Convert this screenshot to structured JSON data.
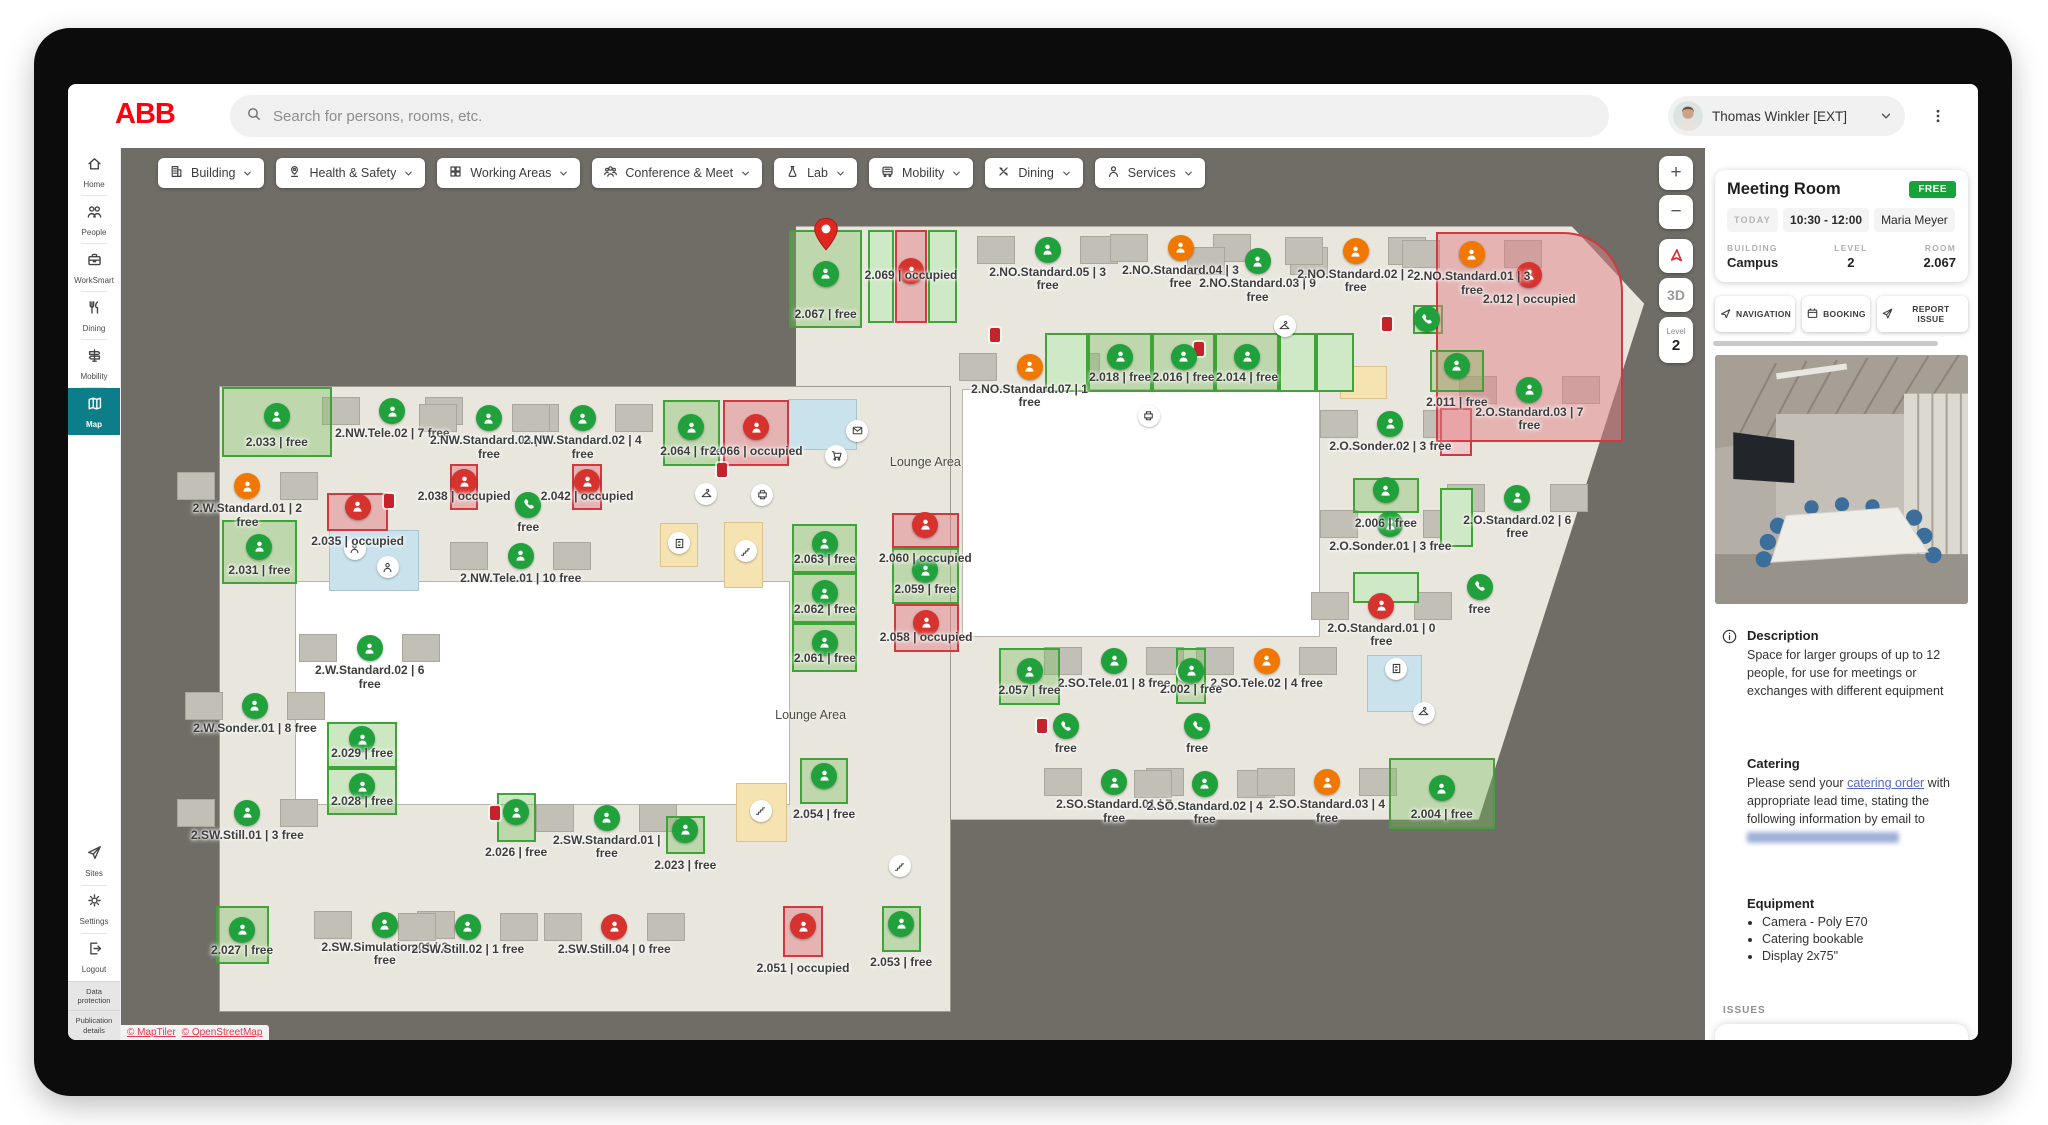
{
  "topbar": {
    "logo": "ABB",
    "search_placeholder": "Search for persons, rooms, etc.",
    "user_name": "Thomas Winkler [EXT]"
  },
  "sidebar": {
    "items": [
      {
        "label": "Home",
        "icon": "home"
      },
      {
        "label": "People",
        "icon": "people"
      },
      {
        "label": "WorkSmart",
        "icon": "worksmart"
      },
      {
        "label": "Dining",
        "icon": "dining"
      },
      {
        "label": "Mobility",
        "icon": "mobility"
      },
      {
        "label": "Map",
        "icon": "map",
        "active": true
      }
    ],
    "bottom_items": [
      {
        "label": "Sites",
        "icon": "sites"
      },
      {
        "label": "Settings",
        "icon": "settings"
      },
      {
        "label": "Logout",
        "icon": "logout"
      }
    ],
    "footer_links": [
      "Data protection",
      "Publication details"
    ]
  },
  "filters": [
    {
      "label": "Building",
      "icon": "building"
    },
    {
      "label": "Health & Safety",
      "icon": "health"
    },
    {
      "label": "Working Areas",
      "icon": "grid"
    },
    {
      "label": "Conference & Meet",
      "icon": "group"
    },
    {
      "label": "Lab",
      "icon": "flask"
    },
    {
      "label": "Mobility",
      "icon": "bus"
    },
    {
      "label": "Dining",
      "icon": "cutlery"
    },
    {
      "label": "Services",
      "icon": "person"
    }
  ],
  "map": {
    "controls": {
      "zoom_in": "+",
      "zoom_out": "−",
      "mode_3d": "3D",
      "level_label": "Level",
      "level_value": "2"
    },
    "attribution": [
      "© MapTiler",
      "© OpenStreetMap"
    ],
    "areas": [
      {
        "label": "Lounge Area",
        "x": 48.7,
        "y": 35.2
      },
      {
        "label": "Lounge Area",
        "x": 41.1,
        "y": 63.6
      }
    ],
    "zones": [
      {
        "cls": "floor-right",
        "x": 40.1,
        "y": 8.8,
        "w": 56.2,
        "h": 66.5
      },
      {
        "cls": "floor",
        "x": 2.0,
        "y": 26.8,
        "w": 48.3,
        "h": 70.0
      },
      {
        "cls": "court",
        "x": 51.2,
        "y": 27.1,
        "w": 23.6,
        "h": 27.6
      },
      {
        "cls": "court",
        "x": 7.0,
        "y": 48.6,
        "w": 32.7,
        "h": 24.9
      },
      {
        "cls": "wc",
        "x": 9.3,
        "y": 42.9,
        "w": 5.8,
        "h": 6.6
      },
      {
        "cls": "wc",
        "x": 39.7,
        "y": 28.2,
        "w": 4.4,
        "h": 5.5
      },
      {
        "cls": "wc",
        "x": 78.0,
        "y": 56.9,
        "w": 3.5,
        "h": 6.2
      },
      {
        "cls": "stairs",
        "x": 31.2,
        "y": 42.2,
        "w": 2.4,
        "h": 4.7
      },
      {
        "cls": "stairs",
        "x": 35.4,
        "y": 42.0,
        "w": 2.5,
        "h": 7.2
      },
      {
        "cls": "stairs",
        "x": 36.2,
        "y": 71.3,
        "w": 3.3,
        "h": 6.4
      },
      {
        "cls": "stairs",
        "x": 76.2,
        "y": 24.5,
        "w": 3.0,
        "h": 3.5
      },
      {
        "cls": "greenbox",
        "x": 44.9,
        "y": 9.2,
        "w": 1.7,
        "h": 10.4
      },
      {
        "cls": "greenbox",
        "x": 48.9,
        "y": 9.2,
        "w": 1.9,
        "h": 10.4
      },
      {
        "cls": "greenbox",
        "x": 56.6,
        "y": 20.7,
        "w": 2.9,
        "h": 6.6
      },
      {
        "cls": "greenbox",
        "x": 72.1,
        "y": 20.7,
        "w": 2.5,
        "h": 6.6
      },
      {
        "cls": "greenbox",
        "x": 74.6,
        "y": 20.7,
        "w": 2.5,
        "h": 6.6
      },
      {
        "cls": "greenbox",
        "x": 82.8,
        "y": 38.1,
        "w": 2.2,
        "h": 6.6
      },
      {
        "cls": "greenbox",
        "x": 77.0,
        "y": 47.5,
        "w": 4.4,
        "h": 3.5
      },
      {
        "cls": "greenbox",
        "x": 81.0,
        "y": 17.6,
        "w": 2.0,
        "h": 3.2
      },
      {
        "cls": "redbox",
        "x": 82.8,
        "y": 29.1,
        "w": 2.1,
        "h": 5.4
      }
    ],
    "rooms": [
      {
        "label": "2.NO.Standard.05 | 3 free",
        "dot": "green",
        "x": 56.8,
        "y": 14.7
      },
      {
        "label": "2.NO.Standard.04 | 3 free",
        "dot": "orange",
        "x": 65.6,
        "y": 14.5
      },
      {
        "label": "2.NO.Standard.03 | 9 free",
        "dot": "green",
        "x": 70.7,
        "y": 16.0
      },
      {
        "label": "2.NO.Standard.02 | 2 free",
        "dot": "orange",
        "x": 77.2,
        "y": 14.9
      },
      {
        "label": "2.NO.Standard.01 | 3 free",
        "dot": "orange",
        "x": 84.9,
        "y": 15.2
      },
      {
        "label": "2.NO.Standard.07 | 1 free",
        "dot": "orange",
        "x": 55.6,
        "y": 27.8
      },
      {
        "label": "2.O.Standard.03 | 7 free",
        "dot": "green",
        "x": 88.7,
        "y": 30.4
      },
      {
        "label": "2.O.Sonder.02 | 3 free",
        "dot": "green",
        "x": 79.5,
        "y": 34.2
      },
      {
        "label": "2.O.Standard.02 | 6 free",
        "dot": "green",
        "x": 87.9,
        "y": 42.5
      },
      {
        "label": "2.O.Sonder.01 | 3 free",
        "dot": "green",
        "x": 79.5,
        "y": 45.5
      },
      {
        "label": "2.O.Standard.01 | 0 free",
        "dot": "red",
        "x": 78.9,
        "y": 54.6
      },
      {
        "label": "2.NW.Tele.02 | 7 free",
        "dot": "green",
        "x": 13.4,
        "y": 32.8
      },
      {
        "label": "2.NW.Standard.03 | 3 free",
        "dot": "green",
        "x": 19.8,
        "y": 33.6
      },
      {
        "label": "2.NW.Standard.02 | 4 free",
        "dot": "green",
        "x": 26.0,
        "y": 33.6
      },
      {
        "label": "2.W.Standard.01 | 2 free",
        "dot": "orange",
        "x": 3.8,
        "y": 41.2
      },
      {
        "label": "2.NW.Tele.01 | 10 free",
        "dot": "green",
        "x": 21.9,
        "y": 49.0
      },
      {
        "label": "2.W.Standard.02 | 6 free",
        "dot": "green",
        "x": 11.9,
        "y": 59.4
      },
      {
        "label": "2.W.Sonder.01 | 8 free",
        "dot": "green",
        "x": 4.3,
        "y": 65.8
      },
      {
        "label": "2.SO.Tele.01 | 8 free",
        "dot": "green",
        "x": 61.2,
        "y": 60.8
      },
      {
        "label": "2.SO.Tele.02 | 4 free",
        "dot": "orange",
        "x": 71.3,
        "y": 60.8
      },
      {
        "label": "2.SO.Standard.01 | 7 free",
        "dot": "green",
        "x": 61.2,
        "y": 74.4
      },
      {
        "label": "2.SO.Standard.02 | 4 free",
        "dot": "green",
        "x": 67.2,
        "y": 74.6
      },
      {
        "label": "2.SO.Standard.03 | 4 free",
        "dot": "orange",
        "x": 75.3,
        "y": 74.4
      },
      {
        "label": "2.SW.Still.01 | 3 free",
        "dot": "green",
        "x": 3.8,
        "y": 77.8
      },
      {
        "label": "2.SW.Standard.01 | free",
        "dot": "green",
        "x": 27.6,
        "y": 78.4
      },
      {
        "label": "2.SW.Simulation.01 | 2 free",
        "dot": "green",
        "x": 12.9,
        "y": 90.4
      },
      {
        "label": "2.SW.Still.02 | 1 free",
        "dot": "green",
        "x": 18.4,
        "y": 90.6
      },
      {
        "label": "2.SW.Still.04 | 0 free",
        "dot": "red",
        "x": 28.1,
        "y": 90.6
      },
      {
        "label": "free",
        "dot": "phone",
        "x": 85.4,
        "y": 49.2
      },
      {
        "label": "free",
        "dot": "phone",
        "x": 22.4,
        "y": 40.0
      },
      {
        "label": "free",
        "dot": "phone",
        "x": 58.0,
        "y": 64.8
      },
      {
        "label": "free",
        "dot": "phone",
        "x": 66.7,
        "y": 64.8
      },
      {
        "label": "",
        "dot": "phone",
        "x": 81.9,
        "y": 19.2
      },
      {
        "label": "2.067 | free",
        "box": "green",
        "dot": "green",
        "pin": true,
        "x": 39.7,
        "y": 9.2,
        "w": 4.8,
        "h": 11.0
      },
      {
        "label": "2.069 | occupied",
        "box": "red",
        "dot": "red",
        "x": 46.7,
        "y": 9.2,
        "w": 2.1,
        "h": 10.4,
        "label_y": 13.6
      },
      {
        "label": "2.012 | occupied",
        "box": "red",
        "dot": "red",
        "x": 82.5,
        "y": 9.4,
        "w": 12.4,
        "h": 23.6,
        "round": true,
        "dot_y": 14.2,
        "label_y": 16.2
      },
      {
        "label": "2.018 | free",
        "box": "green",
        "dot": "green",
        "x": 59.5,
        "y": 20.7,
        "w": 4.2,
        "h": 6.6
      },
      {
        "label": "2.016 | free",
        "box": "green",
        "dot": "green",
        "x": 63.7,
        "y": 20.7,
        "w": 4.2,
        "h": 6.6
      },
      {
        "label": "2.014 | free",
        "box": "green",
        "dot": "green",
        "x": 67.9,
        "y": 20.7,
        "w": 4.2,
        "h": 6.6
      },
      {
        "label": "2.011 | free",
        "box": "green",
        "dot": "green",
        "x": 82.1,
        "y": 22.7,
        "w": 3.6,
        "h": 4.6,
        "label_below": true
      },
      {
        "label": "2.006 | free",
        "box": "green",
        "dot": "green",
        "x": 77.0,
        "y": 37.0,
        "w": 4.4,
        "h": 3.9,
        "label_below": true
      },
      {
        "label": "2.033 | free",
        "box": "green",
        "dot": "green",
        "x": 2.1,
        "y": 26.8,
        "w": 7.3,
        "h": 7.8
      },
      {
        "label": "2.038 | occupied",
        "box": "red",
        "dot": "red",
        "x": 17.2,
        "y": 35.4,
        "w": 1.9,
        "h": 5.2
      },
      {
        "label": "2.042 | occupied",
        "box": "red",
        "dot": "red",
        "x": 25.3,
        "y": 35.4,
        "w": 2.0,
        "h": 5.2
      },
      {
        "label": "2.035 | occupied",
        "box": "red",
        "dot": "red",
        "x": 9.1,
        "y": 38.7,
        "w": 4.0,
        "h": 4.2,
        "label_below": true
      },
      {
        "label": "2.031 | free",
        "box": "green",
        "dot": "green",
        "x": 2.1,
        "y": 41.7,
        "w": 5.0,
        "h": 7.2
      },
      {
        "label": "2.064 | free",
        "box": "green",
        "dot": "green",
        "x": 31.3,
        "y": 28.2,
        "w": 3.8,
        "h": 7.4
      },
      {
        "label": "2.066 | occupied",
        "box": "red",
        "dot": "red",
        "x": 35.3,
        "y": 28.2,
        "w": 4.4,
        "h": 7.4
      },
      {
        "label": "2.063 | free",
        "box": "green",
        "dot": "green",
        "x": 39.9,
        "y": 42.2,
        "w": 4.3,
        "h": 5.5
      },
      {
        "label": "2.062 | free",
        "box": "green",
        "dot": "green",
        "x": 39.9,
        "y": 47.7,
        "w": 4.3,
        "h": 5.6
      },
      {
        "label": "2.061 | free",
        "box": "green",
        "dot": "green",
        "x": 39.9,
        "y": 53.3,
        "w": 4.3,
        "h": 5.5
      },
      {
        "label": "2.060 | occupied",
        "box": "red",
        "dot": "red",
        "x": 46.5,
        "y": 40.9,
        "w": 4.4,
        "h": 3.9,
        "label_below": true
      },
      {
        "label": "2.059 | free",
        "box": "green",
        "dot": "green",
        "x": 46.5,
        "y": 44.8,
        "w": 4.4,
        "h": 6.3
      },
      {
        "label": "2.058 | occupied",
        "box": "red",
        "dot": "red",
        "x": 46.6,
        "y": 51.1,
        "w": 4.3,
        "h": 5.4
      },
      {
        "label": "2.029 | free",
        "box": "green",
        "dot": "green",
        "x": 9.1,
        "y": 64.3,
        "w": 4.6,
        "h": 5.2
      },
      {
        "label": "2.028 | free",
        "box": "green",
        "dot": "green",
        "x": 9.1,
        "y": 69.5,
        "w": 4.6,
        "h": 5.3
      },
      {
        "label": "2.054 | free",
        "box": "green",
        "dot": "green",
        "x": 40.4,
        "y": 68.4,
        "w": 3.2,
        "h": 5.1,
        "label_below": true
      },
      {
        "label": "2.057 | free",
        "box": "green",
        "dot": "green",
        "x": 53.6,
        "y": 56.1,
        "w": 4.0,
        "h": 6.3
      },
      {
        "label": "2.002 | free",
        "box": "green",
        "dot": "green",
        "x": 65.3,
        "y": 56.1,
        "w": 2.0,
        "h": 6.2
      },
      {
        "label": "2.004 | free",
        "box": "green",
        "dot": "green",
        "x": 79.4,
        "y": 68.4,
        "w": 7.0,
        "h": 7.9
      },
      {
        "label": "2.026 | free",
        "box": "green",
        "dot": "green",
        "x": 20.3,
        "y": 72.3,
        "w": 2.6,
        "h": 5.5,
        "label_below": true
      },
      {
        "label": "2.023 | free",
        "box": "green",
        "dot": "green",
        "x": 31.5,
        "y": 74.9,
        "w": 2.6,
        "h": 4.3,
        "label_below": true
      },
      {
        "label": "2.027 | free",
        "box": "green",
        "dot": "green",
        "x": 1.7,
        "y": 85.0,
        "w": 3.5,
        "h": 6.5
      },
      {
        "label": "2.051 | occupied",
        "box": "red",
        "dot": "red",
        "x": 39.3,
        "y": 85.0,
        "w": 2.6,
        "h": 5.7,
        "label_below": true
      },
      {
        "label": "2.053 | free",
        "box": "green",
        "dot": "green",
        "x": 45.8,
        "y": 85.0,
        "w": 2.6,
        "h": 5.1,
        "label_below": true
      }
    ],
    "amenities": [
      {
        "icon": "hanger",
        "x": 34.2,
        "y": 38.8
      },
      {
        "icon": "printer",
        "x": 37.9,
        "y": 38.9
      },
      {
        "icon": "stairs",
        "x": 36.8,
        "y": 45.2
      },
      {
        "icon": "elevator",
        "x": 32.4,
        "y": 44.3
      },
      {
        "icon": "mail",
        "x": 44.2,
        "y": 31.7
      },
      {
        "icon": "cart",
        "x": 42.8,
        "y": 34.5
      },
      {
        "icon": "stairs",
        "x": 37.8,
        "y": 74.3
      },
      {
        "icon": "elevator",
        "x": 66.0,
        "y": 58.8
      },
      {
        "icon": "hanger",
        "x": 72.5,
        "y": 20.0
      },
      {
        "icon": "person",
        "x": 10.9,
        "y": 44.9
      },
      {
        "icon": "person",
        "x": 13.1,
        "y": 47.0
      },
      {
        "icon": "elevator",
        "x": 79.9,
        "y": 58.4
      },
      {
        "icon": "hanger",
        "x": 81.7,
        "y": 63.3
      },
      {
        "icon": "stairs",
        "x": 47.0,
        "y": 80.5
      },
      {
        "icon": "printer",
        "x": 63.5,
        "y": 30.0
      }
    ],
    "extinguishers": [
      {
        "x": 35.2,
        "y": 36.1
      },
      {
        "x": 13.2,
        "y": 39.6
      },
      {
        "x": 56.4,
        "y": 64.8
      },
      {
        "x": 79.3,
        "y": 19.7
      },
      {
        "x": 53.3,
        "y": 21.0
      },
      {
        "x": 20.2,
        "y": 74.5
      },
      {
        "x": 66.8,
        "y": 22.5
      }
    ]
  },
  "panel": {
    "title": "Meeting Room",
    "status_badge": "FREE",
    "schedule_day": "TODAY",
    "schedule_time": "10:30 - 12:00",
    "schedule_person": "Maria Meyer",
    "meta": [
      {
        "label": "BUILDING",
        "value": "Campus"
      },
      {
        "label": "LEVEL",
        "value": "2"
      },
      {
        "label": "ROOM",
        "value": "2.067"
      }
    ],
    "actions": [
      {
        "label": "NAVIGATION",
        "icon": "nav"
      },
      {
        "label": "BOOKING",
        "icon": "calendar"
      },
      {
        "label": "REPORT ISSUE",
        "icon": "sites"
      }
    ],
    "description_title": "Description",
    "description_body": "Space for larger groups of up to 12 people, for use for meetings or exchanges with different equipment",
    "catering_title": "Catering",
    "catering_text_1": "Please send your ",
    "catering_link": "catering order",
    "catering_text_2": " with appropriate lead time, stating the following information by email to ",
    "equipment_title": "Equipment",
    "equipment_items": [
      "Camera - Poly E70",
      "Catering bookable",
      "Display 2x75\""
    ],
    "issues_label": "ISSUES",
    "issue_col": "ISSUE",
    "date_col": "DATE"
  },
  "colors": {
    "abb_red": "#ff000f",
    "accent_teal": "#0b7e8a",
    "free_green": "#21a13c",
    "partial_orange": "#f07800",
    "occupied_red": "#d6332e",
    "badge_green": "#17a23b",
    "map_bg": "#6f6d66",
    "floor": "#e9e6de",
    "room_green_border": "#3fa437",
    "room_red_border": "#cf3940",
    "wc_blue": "#c9e2ec",
    "stairs_yellow": "#f6e3b2",
    "link_blue": "#5468c8"
  }
}
